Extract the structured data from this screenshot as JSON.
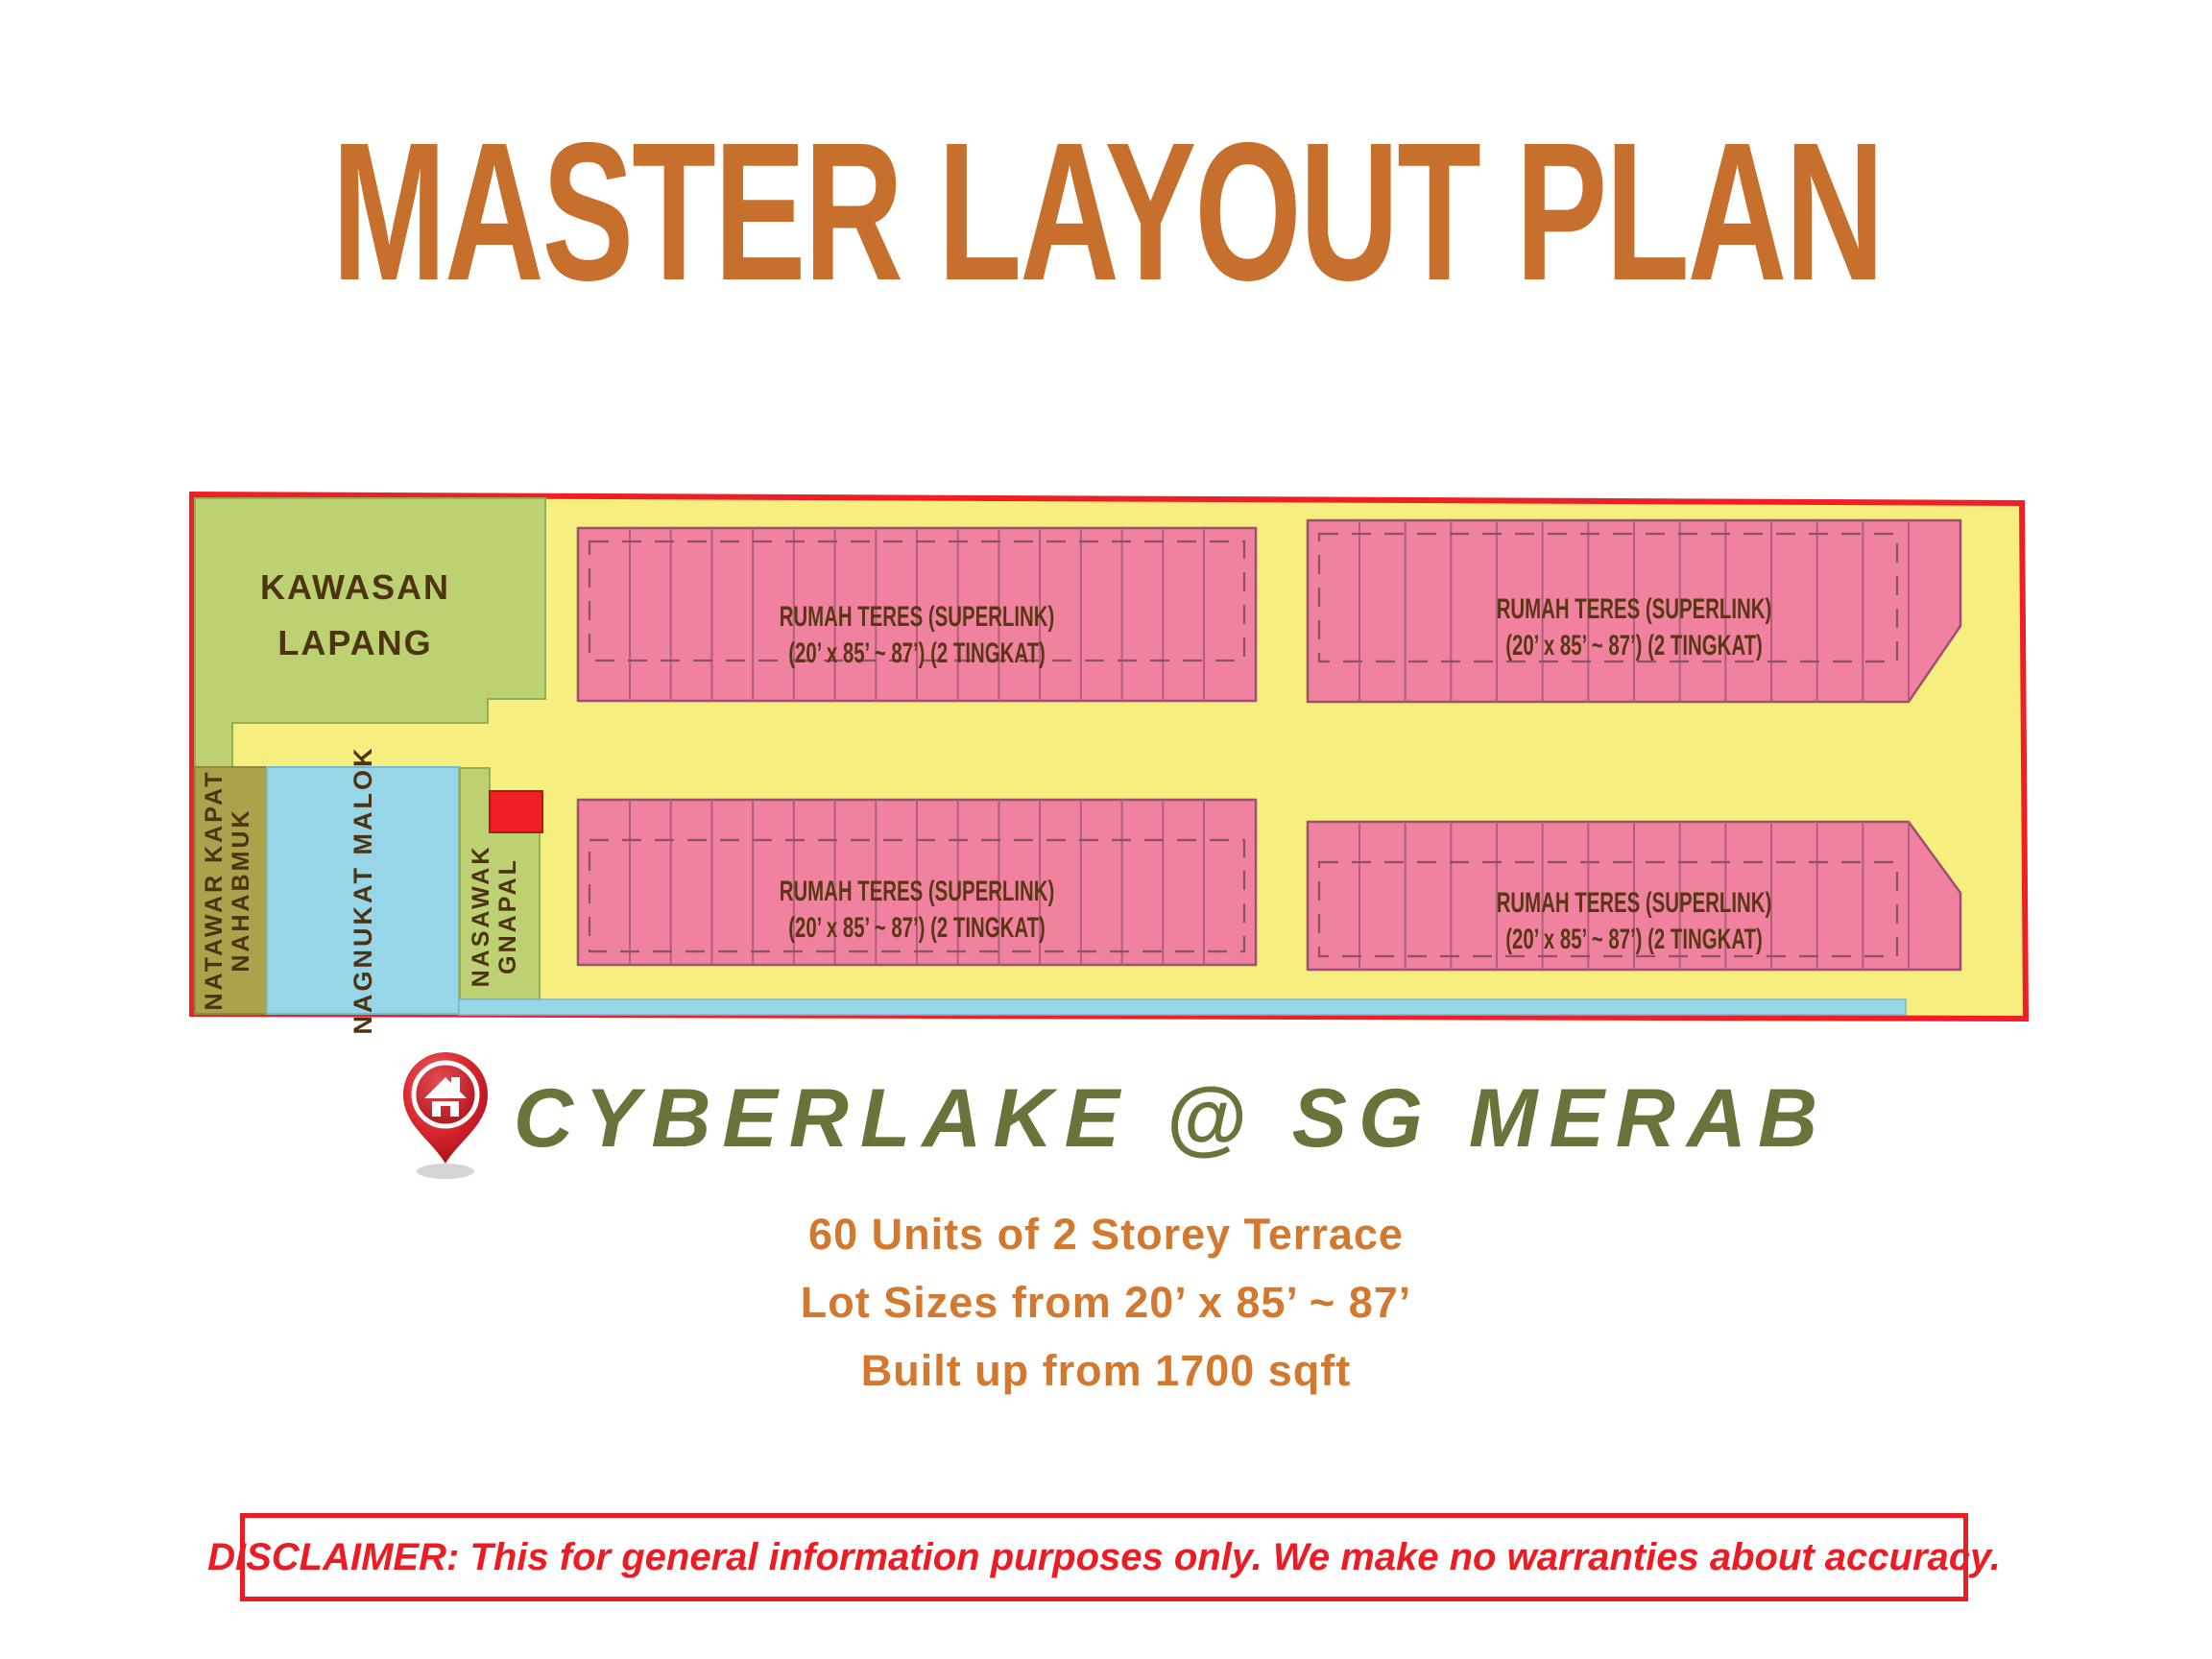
{
  "page": {
    "title": "MASTER LAYOUT PLAN"
  },
  "plan": {
    "areas": {
      "open_space_main": {
        "line1": "KAWASAN",
        "line2": "LAPANG"
      },
      "sewage_treatment_site": {
        "line1": "TAPAK RAWATAN",
        "line2": "KUMBAHAN"
      },
      "retention_pond": {
        "label": "KOLAM TAKUNGAN"
      },
      "open_space_strip": {
        "line1": "KAWASAN",
        "line2": "LAPANG"
      }
    },
    "blocks": [
      {
        "id": "top-left",
        "label_line1": "RUMAH TERES (SUPERLINK)",
        "label_line2": "(20’ x 85’ ~ 87’) (2 TINGKAT)",
        "lots": 16
      },
      {
        "id": "top-right",
        "label_line1": "RUMAH TERES (SUPERLINK)",
        "label_line2": "(20’ x 85’ ~ 87’) (2 TINGKAT)",
        "lots": 14
      },
      {
        "id": "bottom-left",
        "label_line1": "RUMAH TERES (SUPERLINK)",
        "label_line2": "(20’ x 85’ ~ 87’) (2 TINGKAT)",
        "lots": 16
      },
      {
        "id": "bottom-right",
        "label_line1": "RUMAH TERES (SUPERLINK)",
        "label_line2": "(20’ x 85’ ~ 87’) (2 TINGKAT)",
        "lots": 14
      }
    ],
    "colors": {
      "road": "#F6EF7F",
      "boundary": "#EE2026",
      "housing": "#F0819F",
      "open_space": "#BCD172",
      "pond": "#97D6E9",
      "sewage": "#ABA24C",
      "marker": "#EE2026",
      "map_text": "#4E3312"
    }
  },
  "logo": {
    "name": "CYBERLAKE @ SG MERAB",
    "icon": "map-pin-house"
  },
  "details": {
    "line1": "60 Units of 2 Storey Terrace",
    "line2": "Lot Sizes from 20’ x 85’ ~ 87’",
    "line3": "Built up from 1700 sqft"
  },
  "disclaimer": {
    "text": "DISCLAIMER: This for general information purposes only. We make no warranties about accuracy."
  }
}
